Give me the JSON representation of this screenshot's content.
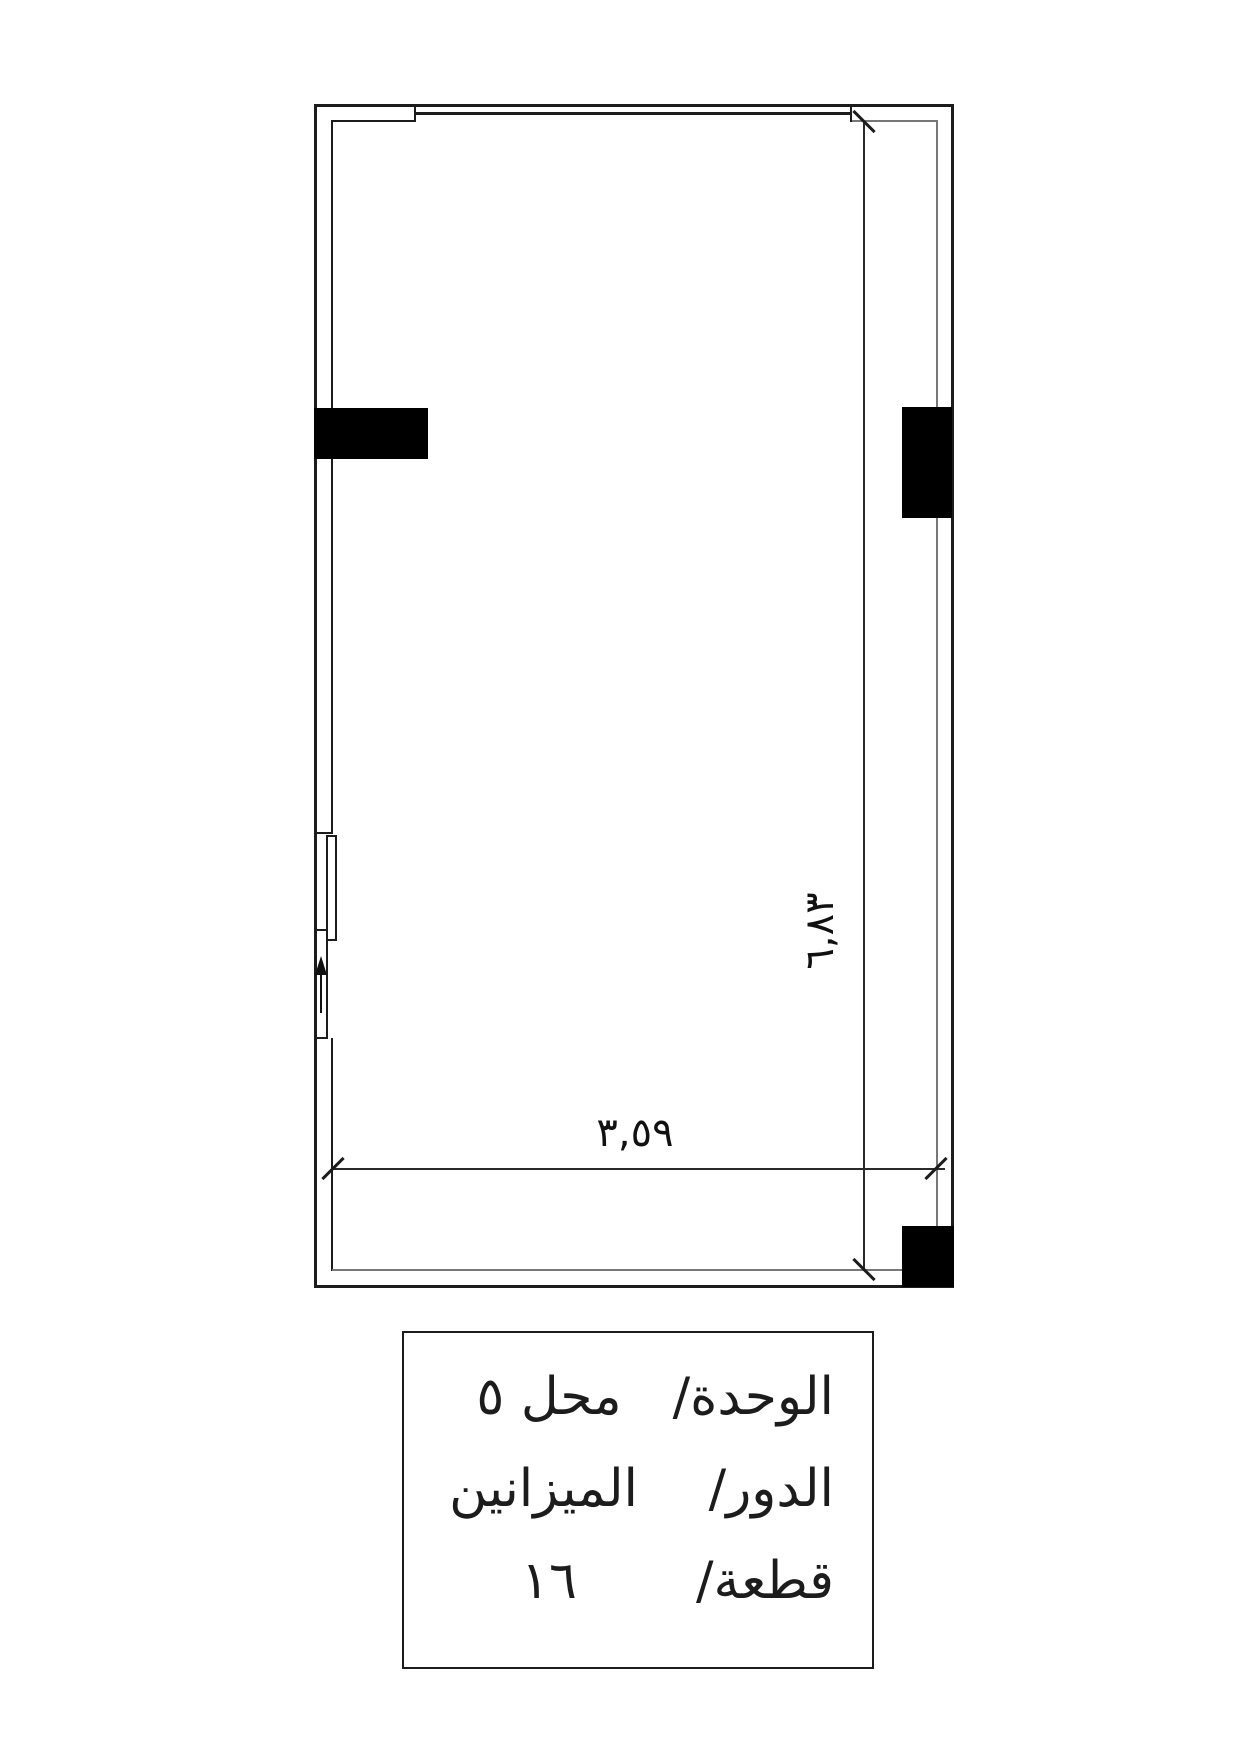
{
  "drawing": {
    "type": "floor-plan",
    "dimensions": {
      "width_label": "٣,٥٩",
      "height_label": "٦,٨٣"
    },
    "entry_arrow_icon": "up-arrow",
    "colors": {
      "background": "#ffffff",
      "wall_line": "#1c1c1c",
      "inner_wall_line": "#777777",
      "column_fill": "#000000"
    }
  },
  "title_block": {
    "rows": [
      {
        "label": "الوحدة/",
        "value": "محل ٥"
      },
      {
        "label": "الدور/",
        "value": "الميزانين"
      },
      {
        "label": "قطعة/",
        "value": "١٦"
      }
    ]
  }
}
